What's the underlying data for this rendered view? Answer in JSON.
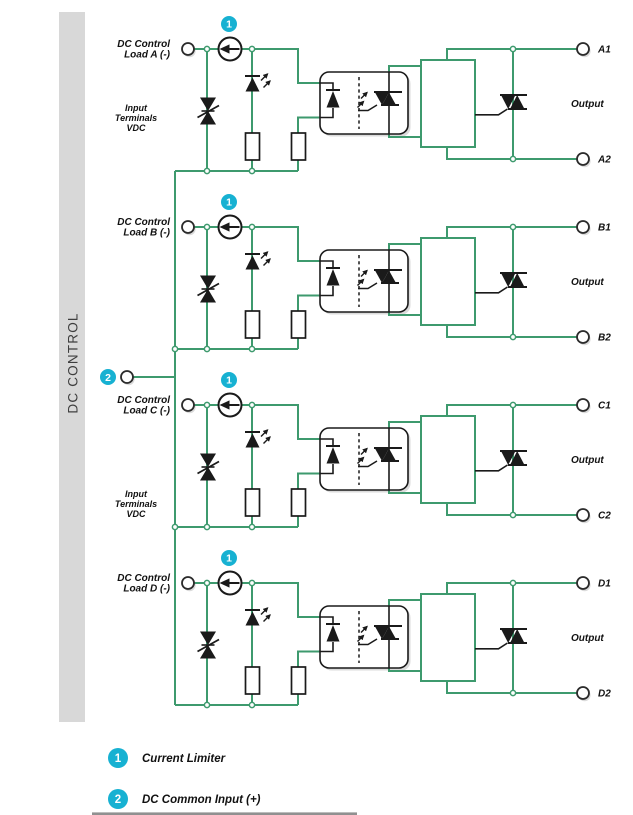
{
  "sidebar": {
    "label": "DC CONTROL"
  },
  "input_group_labels": [
    {
      "line1": "Input",
      "line2": "Terminals",
      "line3": "VDC"
    },
    {
      "line1": "Input",
      "line2": "Terminals",
      "line3": "VDC"
    }
  ],
  "common_input": {
    "badge": "2"
  },
  "channels": [
    {
      "badge": "1",
      "load_line1": "DC Control",
      "load_line2": "Load A (-)",
      "out1": "A1",
      "out2": "A2",
      "output_label": "Output"
    },
    {
      "badge": "1",
      "load_line1": "DC Control",
      "load_line2": "Load B (-)",
      "out1": "B1",
      "out2": "B2",
      "output_label": "Output"
    },
    {
      "badge": "1",
      "load_line1": "DC Control",
      "load_line2": "Load C (-)",
      "out1": "C1",
      "out2": "C2",
      "output_label": "Output"
    },
    {
      "badge": "1",
      "load_line1": "DC Control",
      "load_line2": "Load D (-)",
      "out1": "D1",
      "out2": "D2",
      "output_label": "Output"
    }
  ],
  "legend": [
    {
      "num": "1",
      "label": "Current Limiter"
    },
    {
      "num": "2",
      "label": "DC Common Input (+)"
    }
  ],
  "colors": {
    "wire": "#3E9A6E",
    "badge": "#17B1D2",
    "sidebar_bar": "#D8D8D8",
    "ink": "#1A1A1A"
  }
}
